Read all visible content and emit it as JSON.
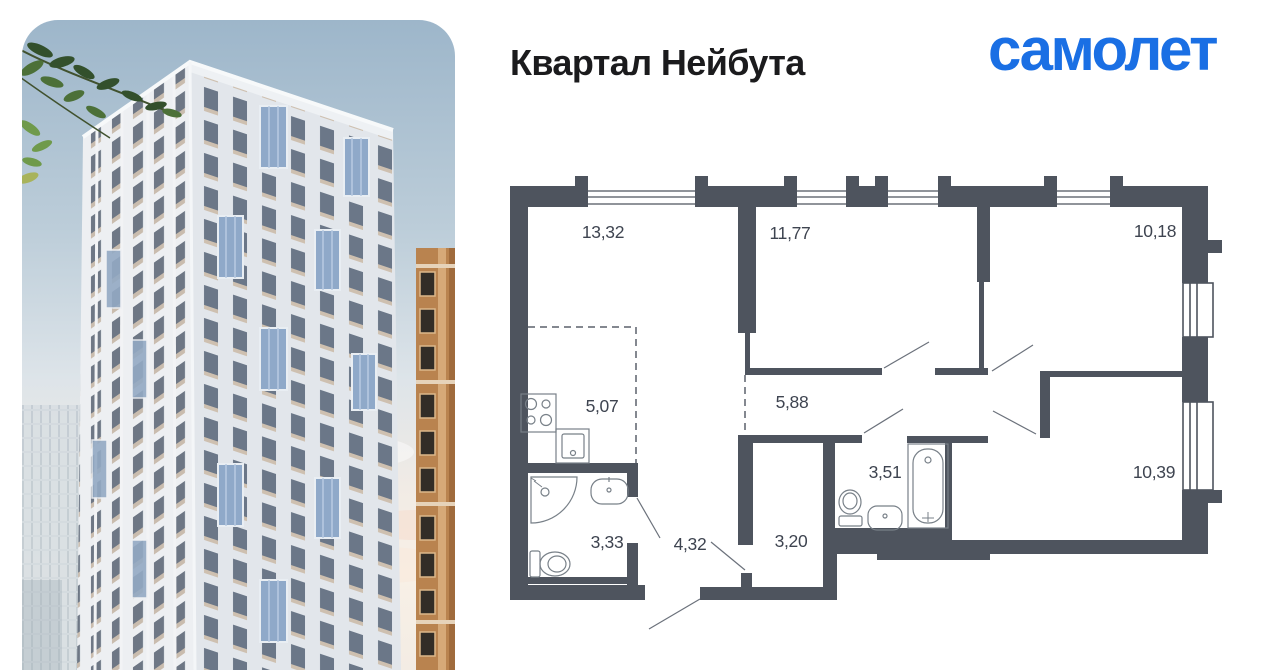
{
  "header": {
    "project_title": "Квартал Нейбута",
    "brand_logo": "самолет"
  },
  "colors": {
    "brand_blue": "#1a6fe4",
    "title_black": "#1b1b1d",
    "plan_wall": "#4e545e",
    "plan_label": "#3e4450",
    "sky_top": "#9db6ca",
    "sky_horizon": "#f8f0e6",
    "balcony_glass": "#8fa9c9",
    "accent_building": "#b9834f"
  },
  "floor_plan": {
    "rooms": [
      {
        "key": "living-room",
        "area": "13,32"
      },
      {
        "key": "bedroom-1",
        "area": "11,77"
      },
      {
        "key": "bedroom-2",
        "area": "10,18"
      },
      {
        "key": "kitchen-zone",
        "area": "5,07"
      },
      {
        "key": "corridor",
        "area": "5,88"
      },
      {
        "key": "bathroom-1",
        "area": "3,51"
      },
      {
        "key": "room",
        "area": "10,39"
      },
      {
        "key": "bathroom-2",
        "area": "3,33"
      },
      {
        "key": "hallway",
        "area": "4,32"
      },
      {
        "key": "corridor-2",
        "area": "3,20"
      }
    ]
  }
}
